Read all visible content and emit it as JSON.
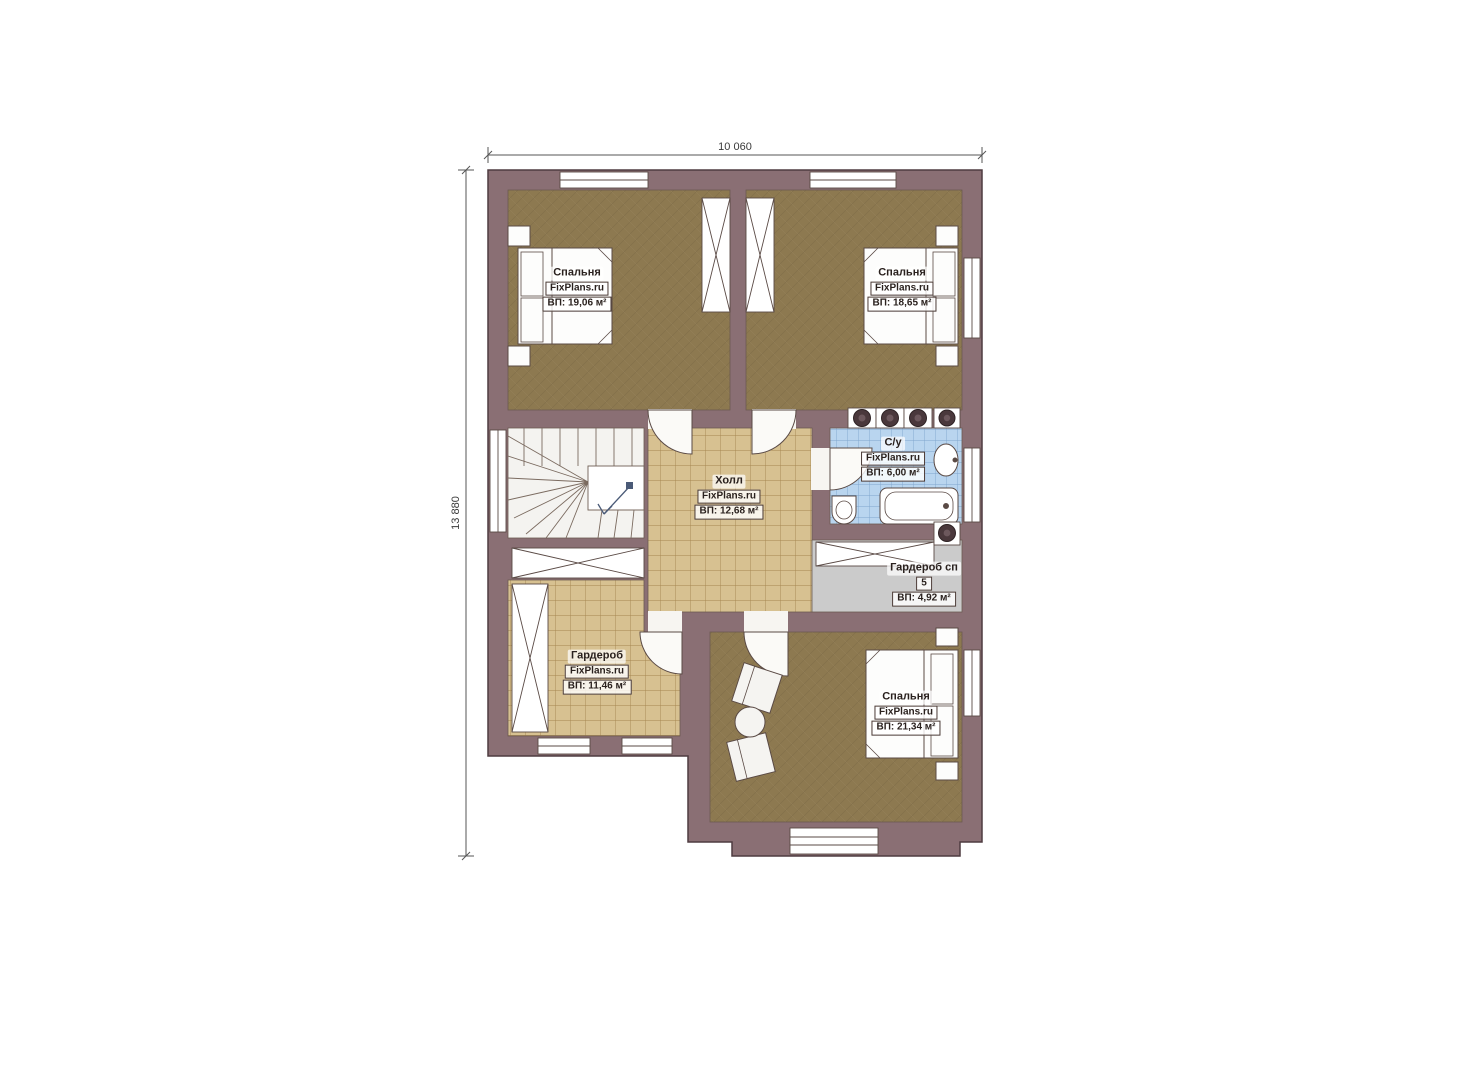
{
  "plan": {
    "brand": "FixPlans.ru",
    "dimensions": {
      "width": "10 060",
      "height": "13 880"
    },
    "rooms": [
      {
        "key": "bedroom-1",
        "name": "Спальня",
        "brand": "FixPlans.ru",
        "area": "ВП: 19,06 м²"
      },
      {
        "key": "bedroom-2",
        "name": "Спальня",
        "brand": "FixPlans.ru",
        "area": "ВП: 18,65 м²"
      },
      {
        "key": "hall",
        "name": "Холл",
        "brand": "FixPlans.ru",
        "area": "ВП: 12,68 м²"
      },
      {
        "key": "bathroom",
        "name": "С/у",
        "brand": "FixPlans.ru",
        "area": "ВП: 6,00 м²"
      },
      {
        "key": "wardrobe-sp",
        "name": "Гардероб сп",
        "brand": "5",
        "area": "ВП: 4,92 м²"
      },
      {
        "key": "wardrobe",
        "name": "Гардероб",
        "brand": "FixPlans.ru",
        "area": "ВП: 11,46 м²"
      },
      {
        "key": "bedroom-3",
        "name": "Спальня",
        "brand": "FixPlans.ru",
        "area": "ВП: 21,34 м²"
      }
    ],
    "colors": {
      "wall": "#8a6f74",
      "bedroom_floor": "#8d7950",
      "tile_floor": "#d7c191",
      "bathroom_floor": "#b9d5ef",
      "utility_floor": "#cbcbcb",
      "fixture": "#3f3434"
    }
  }
}
